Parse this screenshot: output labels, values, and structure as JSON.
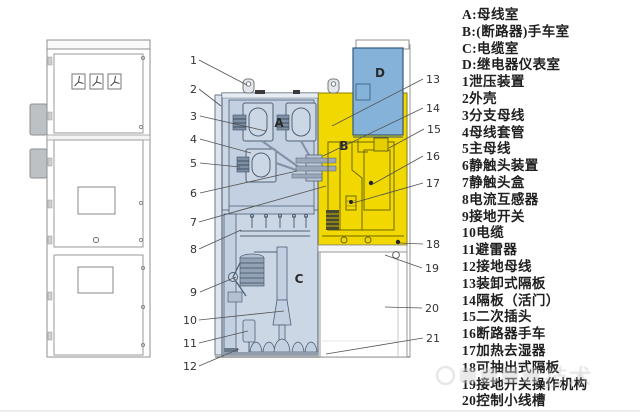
{
  "legend": {
    "items": [
      "A:母线室",
      "B:(断路器)手车室",
      "C:电缆室",
      "D:继电器仪表室",
      "1泄压装置",
      "2外壳",
      "3分支母线",
      "4母线套管",
      "5主母线",
      "6静触头装置",
      "7静触头盒",
      "8电流互感器",
      "9接地开关",
      "10电缆",
      "11避雷器",
      "12接地母线",
      "13装卸式隔板",
      "14隔板（活门）",
      "15二次插头",
      "16断路器手车",
      "17加热去湿器",
      "18可抽出式隔板",
      "19接地开关操作机构",
      "20控制小线槽"
    ]
  },
  "diagram": {
    "compartment_labels": {
      "A": "A",
      "B": "B",
      "C": "C",
      "D": "D"
    },
    "callouts": [
      "1",
      "2",
      "3",
      "4",
      "5",
      "6",
      "7",
      "8",
      "9",
      "10",
      "11",
      "12",
      "13",
      "14",
      "15",
      "16",
      "17",
      "18",
      "19",
      "20",
      "21"
    ]
  },
  "watermark": {
    "visible_text": "技术"
  },
  "colors": {
    "busbar_cable_compartment_fill": "#ccd7e6",
    "breaker_compartment_fill": "#f2d801",
    "relay_compartment_fill": "#85b2d8",
    "diagram_line": "#5f7082",
    "breaker_outline": "#6f6600"
  }
}
